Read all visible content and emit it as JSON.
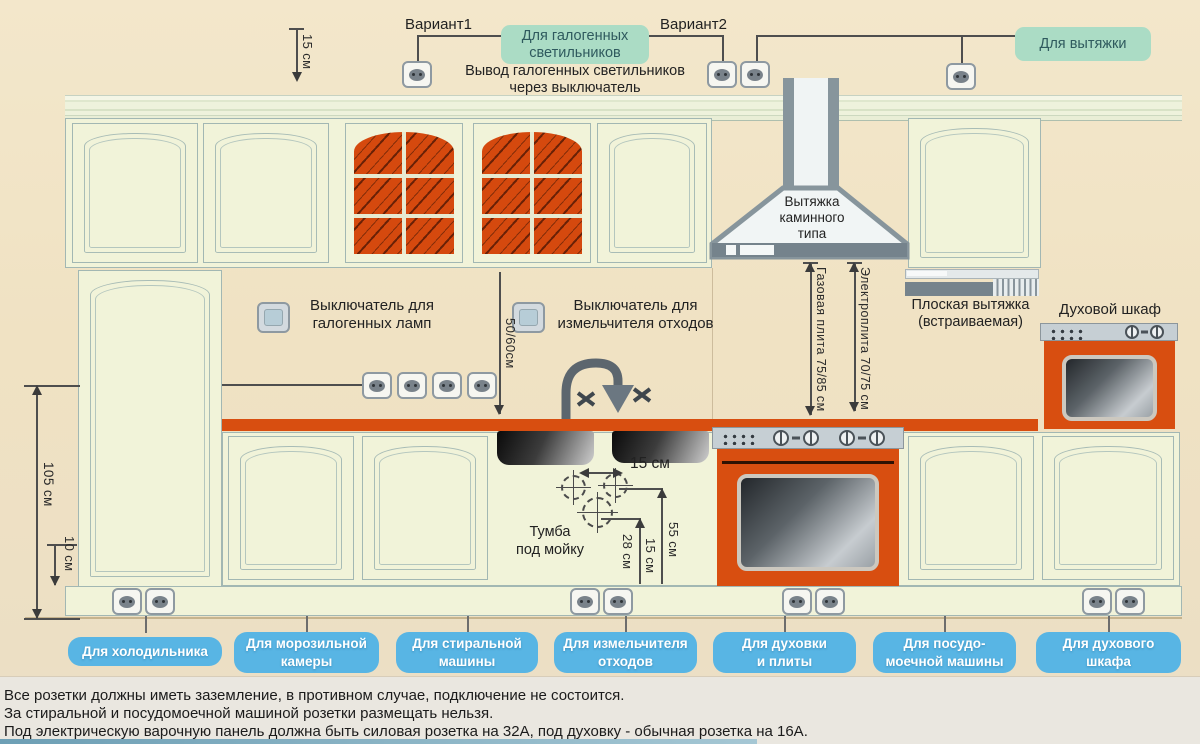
{
  "title": "Схема размещения розеток на кухне",
  "colors": {
    "accent_orange": "#d84e10",
    "outlet_label_blue": "#58b5e4",
    "tag_green": "#abdcc5",
    "cabinet_cream": "#f1f3d9"
  },
  "top": {
    "dim_15cm": "15 см",
    "variant1": "Вариант1",
    "variant2": "Вариант2",
    "halogen_tag": "Для галогенных\nсветильников",
    "hood_tag": "Для вытяжки",
    "halogen_note": "Вывод галогенных светильников\nчерез выключатель"
  },
  "wall": {
    "switch_halogen_label": "Выключатель для\nгалогенных ламп",
    "switch_disposer_label": "Выключатель для\nизмельчителя отходов",
    "dim_50_60": "50/60см",
    "dim_105": "105 см",
    "dim_10": "10 см"
  },
  "hood": {
    "chimney_label": "Вытяжка\nкаминного\nтипа",
    "flat_label": "Плоская вытяжка\n(встраиваемая)",
    "gas_dim": "Газовая плита 75/85 см",
    "electric_dim": "Электроплита 70/75 см"
  },
  "oven": {
    "label": "Духовой шкаф"
  },
  "sink": {
    "cabinet_label": "Тумба\nпод мойку",
    "dim_15_top": "15 см",
    "dim_28": "28 см",
    "dim_15_mid": "15 см",
    "dim_55": "55 см"
  },
  "outlet_labels": [
    {
      "label": "Для холодильника"
    },
    {
      "label": "Для морозильной\nкамеры"
    },
    {
      "label": "Для стиральной\nмашины"
    },
    {
      "label": "Для измельчителя\nотходов"
    },
    {
      "label": "Для духовки\nи плиты"
    },
    {
      "label": "Для посудо-\nмоечной машины"
    },
    {
      "label": "Для духового\nшкафа"
    }
  ],
  "footer": {
    "line1": "Все розетки должны иметь заземление, в противном случае, подключение не состоится.",
    "line2": "За стиральной и посудомоечной машиной розетки размещать нельзя.",
    "line3": "Под электрическую варочную панель должна быть силовая розетка на 32А, под духовку - обычная розетка на 16А."
  }
}
